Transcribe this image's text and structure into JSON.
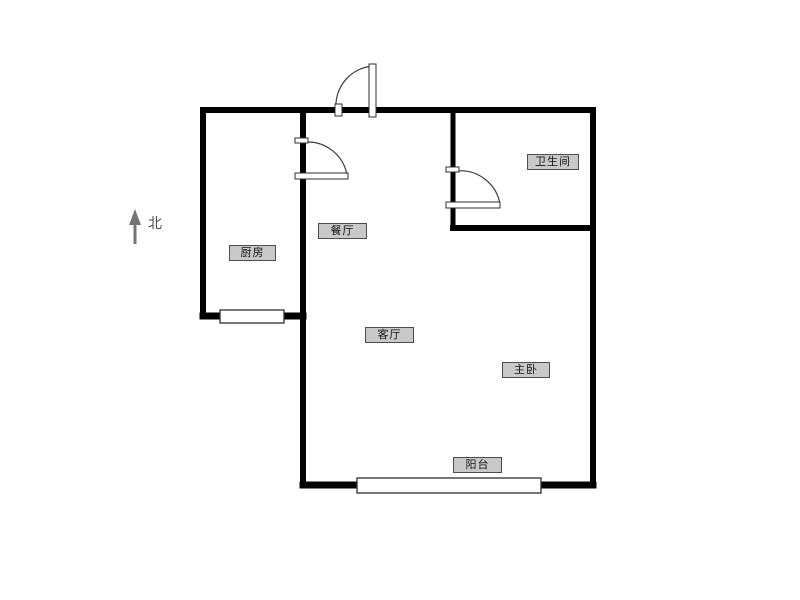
{
  "floor_plan": {
    "compass": {
      "label": "北"
    },
    "rooms": {
      "kitchen": {
        "label": "厨房"
      },
      "dining": {
        "label": "餐厅"
      },
      "bathroom": {
        "label": "卫生间"
      },
      "living": {
        "label": "客厅"
      },
      "bedroom": {
        "label": "主卧"
      },
      "balcony": {
        "label": "阳台"
      }
    },
    "colors": {
      "background": "#ffffff",
      "wall": "#000000",
      "label_bg": "#c9c9c9",
      "label_border": "#4d4d4d",
      "door_line": "#3c3c3c",
      "window_border": "#2e2e2e",
      "arrow": "#757575"
    }
  }
}
